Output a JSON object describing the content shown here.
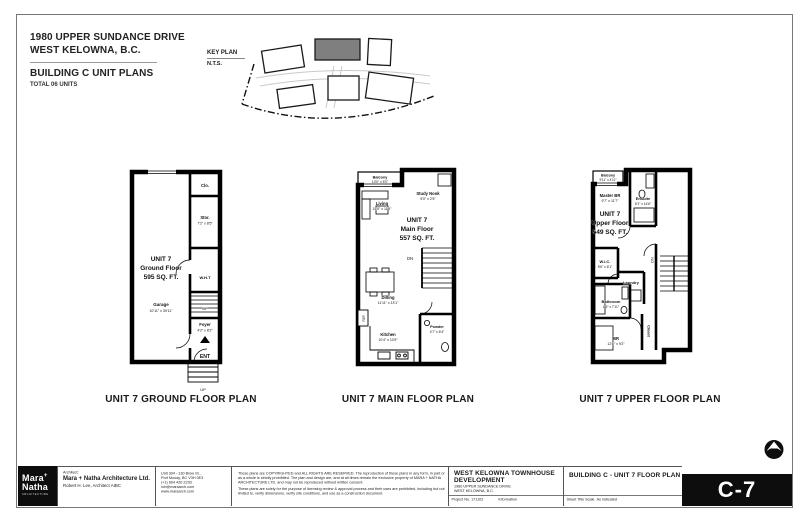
{
  "header": {
    "address_line1": "1980 UPPER SUNDANCE DRIVE",
    "address_line2": "WEST KELOWNA, B.C.",
    "title": "BUILDING C UNIT PLANS",
    "subtitle": "TOTAL 06 UNITS"
  },
  "key_plan": {
    "label": "KEY PLAN",
    "scale": "N.T.S."
  },
  "ground": {
    "unit": "UNIT 7",
    "floor": "Ground Floor",
    "area": "595 SQ. FT.",
    "caption": "UNIT 7 GROUND FLOOR PLAN",
    "clo": "Clo.",
    "stor": "Stor.",
    "stor_dim": "7'2\" x 8'5\"",
    "wht": "W.H.T",
    "garage": "Garage",
    "garage_dim": "10'11\" x 39'11\"",
    "foyer": "Foyer",
    "foyer_dim": "4'2\" x 8'2\"",
    "ent": "ENT",
    "up_stair": "UP",
    "up_entry": "UP"
  },
  "main": {
    "unit": "UNIT 7",
    "floor": "Main Floor",
    "area": "557 SQ. FT.",
    "caption": "UNIT 7 MAIN FLOOR PLAN",
    "balcony": "Balcony",
    "balcony_dim": "10'0\" x 5'0\"",
    "living": "Living",
    "living_dim": "15'5\" x 11'9\"",
    "study": "Study Nook",
    "study_dim": "5'0\" x 2'5\"",
    "dn": "DN",
    "dining": "Dining",
    "dining_dim": "11'11\" x 13'1\"",
    "kitchen": "Kitchen",
    "kitchen_dim": "10'4\" x 10'9\"",
    "powder": "Powder",
    "powder_dim": "4'7\" x 6'4\"",
    "ref": "REF."
  },
  "upper": {
    "unit": "UNIT 7",
    "floor": "Upper Floor",
    "area": "549 SQ. FT.",
    "caption": "UNIT 7 UPPER FLOOR PLAN",
    "balcony": "Balcony",
    "balcony_dim": "9'11\" x 4'11\"",
    "master": "Master BR",
    "master_dim": "9'7\" x 11'7\"",
    "ensuite": "Ensuite",
    "ensuite_dim": "5'1\" x 14'6\"",
    "wic": "W.I.C.",
    "wic_dim": "5'6\" x 6'1\"",
    "laundry": "Laundry",
    "bathroom": "Bathroom",
    "bathroom_dim": "8'5\" x 7'11\"",
    "br": "BR",
    "br_dim": "12'6\" x 9'2\"",
    "closet": "Closet",
    "dn": "DN"
  },
  "titleblock": {
    "logo_line1": "Mara",
    "logo_plus": "+",
    "logo_line2": "Natha",
    "logo_sub": "ARCHITECTURE",
    "architect_label": "Architect:",
    "firm": "Mara + Natha Architecture Ltd.",
    "architect": "Robert H. Lee, Architect AIBC",
    "address1": "Unit 304 - 130 Brew St.,",
    "address2": "Port Moody, BC V3H 0E3",
    "phone": "(+1) 604 420 2233",
    "email": "rob@maraarch.com",
    "website": "www.maraarch.com",
    "disclaimer1": "These plans are COPYRIGHTED and ALL RIGHTS ARE RESERVED. The reproduction of these plans in any form, in part or as a whole is strictly prohibited. The plan and design are, and at all times remain the exclusive property of MARA + NATHA ARCHITECTURE LTD. and may not be reproduced without written consent.",
    "disclaimer2": "These plans are solely for the purpose of licensing review & approval process and their uses are prohibited, including but not limited to, verify dimensions, verify site conditions, and use as a construction document.",
    "project_name1": "WEST KELOWNA TOWNHOUSE",
    "project_name2": "DEVELOPMENT",
    "project_addr1": "1980 UPPER SUNDANCE DRIVE",
    "project_addr2": "WEST KELOWNA, B.C.",
    "project_no": "Project No. 171102",
    "info": "Information",
    "sheet_title": "BUILDING C - UNIT 7 FLOOR PLAN",
    "sheet_title_label": "Sheet Title",
    "scale_label": "Scale",
    "scale_value": "As indicated",
    "sheet_no": "C-7",
    "north": "N"
  }
}
